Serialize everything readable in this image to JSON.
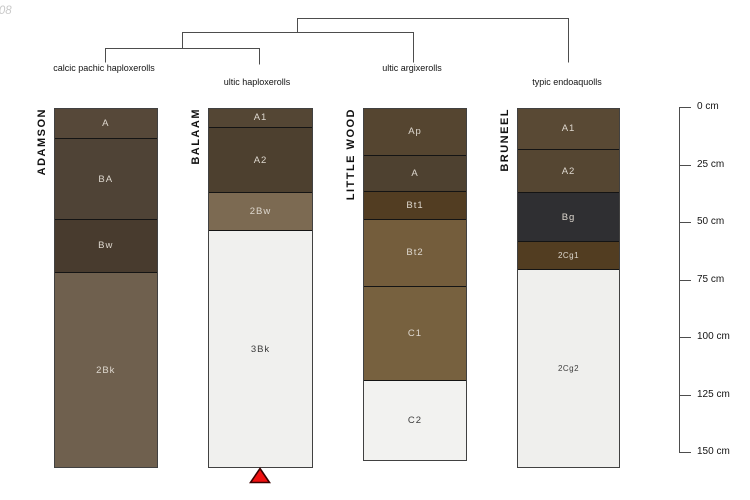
{
  "watermark": "-08",
  "figure": {
    "type": "soil-profile-dendrogram",
    "background": "#ffffff",
    "line_color": "#4d4d4d"
  },
  "dendrogram": {
    "taxonomy_labels": [
      "calcic pachic haploxerolls",
      "ultic haploxerolls",
      "ultic argixerolls",
      "typic endoaquolls"
    ],
    "merge_order": [
      [
        "calcic pachic haploxerolls",
        "ultic haploxerolls"
      ],
      [
        "cluster-1",
        "ultic argixerolls"
      ],
      [
        "cluster-2",
        "typic endoaquolls"
      ]
    ]
  },
  "depth_axis": {
    "unit": "cm",
    "ticks": [
      {
        "value": 0,
        "label": "0 cm"
      },
      {
        "value": 25,
        "label": "25 cm"
      },
      {
        "value": 50,
        "label": "50 cm"
      },
      {
        "value": 75,
        "label": "75 cm"
      },
      {
        "value": 100,
        "label": "100 cm"
      },
      {
        "value": 125,
        "label": "125 cm"
      },
      {
        "value": 150,
        "label": "150 cm"
      }
    ]
  },
  "chart_data": {
    "type": "bar",
    "variant": "stacked-soil-horizon-columns",
    "ylabel": "depth (cm)",
    "ylim": [
      0,
      150
    ],
    "y_ticks": [
      0,
      25,
      50,
      75,
      100,
      125,
      150
    ],
    "profiles": [
      {
        "name": "ADAMSON",
        "taxonomy": "calcic pachic haploxerolls",
        "horizons": [
          {
            "label": "A",
            "top_cm": 0,
            "bottom_cm": 13,
            "color": "#564839",
            "text": "light"
          },
          {
            "label": "BA",
            "top_cm": 13,
            "bottom_cm": 48,
            "color": "#4f4336",
            "text": "light"
          },
          {
            "label": "Bw",
            "top_cm": 48,
            "bottom_cm": 71,
            "color": "#483b2e",
            "text": "light"
          },
          {
            "label": "2Bk",
            "top_cm": 71,
            "bottom_cm": 156,
            "color": "#6f604e",
            "text": "light"
          }
        ]
      },
      {
        "name": "BALAAM",
        "taxonomy": "ultic haploxerolls",
        "marker": {
          "shape": "triangle-up",
          "color": "#f01111",
          "edge": "#3c0000",
          "position": "below-column"
        },
        "horizons": [
          {
            "label": "A1",
            "top_cm": 0,
            "bottom_cm": 8,
            "color": "#544634",
            "text": "light"
          },
          {
            "label": "A2",
            "top_cm": 8,
            "bottom_cm": 36.5,
            "color": "#4d402f",
            "text": "light"
          },
          {
            "label": "2Bw",
            "top_cm": 36.5,
            "bottom_cm": 53,
            "color": "#7c6a52",
            "text": "light"
          },
          {
            "label": "3Bk",
            "top_cm": 53,
            "bottom_cm": 156,
            "color": "#f0f0ee",
            "text": "dark"
          }
        ]
      },
      {
        "name": "LITTLE WOOD",
        "taxonomy": "ultic argixerolls",
        "horizons": [
          {
            "label": "Ap",
            "top_cm": 0,
            "bottom_cm": 20,
            "color": "#554530",
            "text": "light"
          },
          {
            "label": "A",
            "top_cm": 20,
            "bottom_cm": 36,
            "color": "#4e4130",
            "text": "light"
          },
          {
            "label": "Bt1",
            "top_cm": 36,
            "bottom_cm": 48,
            "color": "#523d22",
            "text": "light"
          },
          {
            "label": "Bt2",
            "top_cm": 48,
            "bottom_cm": 77,
            "color": "#745d3c",
            "text": "light"
          },
          {
            "label": "C1",
            "top_cm": 77,
            "bottom_cm": 118,
            "color": "#77613f",
            "text": "light"
          },
          {
            "label": "C2",
            "top_cm": 118,
            "bottom_cm": 153,
            "color": "#f2f2f0",
            "text": "dark"
          }
        ]
      },
      {
        "name": "BRUNEEL",
        "taxonomy": "typic endoaquolls",
        "horizons": [
          {
            "label": "A1",
            "top_cm": 0,
            "bottom_cm": 17.5,
            "color": "#594934",
            "text": "light"
          },
          {
            "label": "A2",
            "top_cm": 17.5,
            "bottom_cm": 36.5,
            "color": "#554632",
            "text": "light"
          },
          {
            "label": "Bg",
            "top_cm": 36.5,
            "bottom_cm": 57.5,
            "color": "#2f2f32",
            "text": "light"
          },
          {
            "label": "2Cg1",
            "top_cm": 57.5,
            "bottom_cm": 70,
            "color": "#523d21",
            "text": "light",
            "small": true
          },
          {
            "label": "2Cg2",
            "top_cm": 70,
            "bottom_cm": 156,
            "color": "#efefed",
            "text": "dark",
            "small": true
          }
        ]
      }
    ]
  }
}
